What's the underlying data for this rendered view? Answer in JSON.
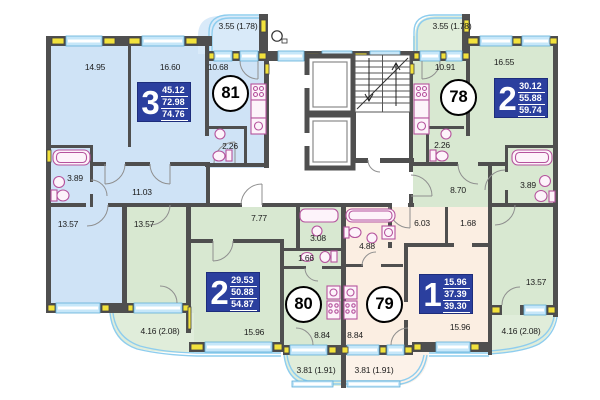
{
  "plan_title": "Residential section floor plan",
  "units": [
    {
      "number": "81",
      "rooms": "3",
      "area_living": "45.12",
      "area_total": "72.98",
      "area_with_balcony": "74.76"
    },
    {
      "number": "78",
      "rooms": "2",
      "area_living": "30.12",
      "area_total": "55.88",
      "area_with_balcony": "59.74"
    },
    {
      "number": "80",
      "rooms": "2",
      "area_living": "29.53",
      "area_total": "50.88",
      "area_with_balcony": "54.87"
    },
    {
      "number": "79",
      "rooms": "1",
      "area_living": "15.96",
      "area_total": "37.39",
      "area_with_balcony": "39.30"
    }
  ],
  "room_labels": [
    {
      "text": "14.95"
    },
    {
      "text": "16.60"
    },
    {
      "text": "10.68"
    },
    {
      "text": "3.55 (1.78)"
    },
    {
      "text": "2.26"
    },
    {
      "text": "3.89"
    },
    {
      "text": "11.03"
    },
    {
      "text": "13.57"
    },
    {
      "text": "10.91"
    },
    {
      "text": "16.55"
    },
    {
      "text": "3.55 (1.78)"
    },
    {
      "text": "2.26"
    },
    {
      "text": "8.70"
    },
    {
      "text": "3.89"
    },
    {
      "text": "13.57"
    },
    {
      "text": "4.16 (2.08)"
    },
    {
      "text": "13.57"
    },
    {
      "text": "7.77"
    },
    {
      "text": "3.08"
    },
    {
      "text": "1.66"
    },
    {
      "text": "15.96"
    },
    {
      "text": "8.84"
    },
    {
      "text": "4.16 (2.08)"
    },
    {
      "text": "3.81 (1.91)"
    },
    {
      "text": "6.03"
    },
    {
      "text": "1.68"
    },
    {
      "text": "4.88"
    },
    {
      "text": "8.84"
    },
    {
      "text": "15.96"
    },
    {
      "text": "3.81 (1.91)"
    }
  ],
  "colors": {
    "apartment_blue": "#cfe3f6",
    "apartment_green": "#d8e8d1",
    "apartment_cream": "#fbeee2",
    "area_box_blue": "#2b3f9e",
    "wall_gray": "#4f4f4f",
    "window_blue": "#a8d8f0",
    "sill_yellow": "#f2e23c",
    "fixture_pink": "#b5539d"
  }
}
